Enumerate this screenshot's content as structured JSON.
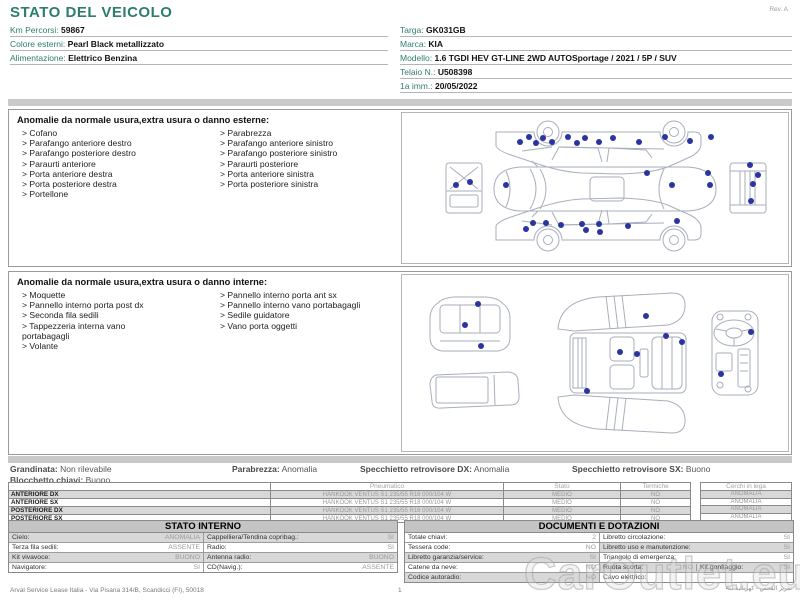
{
  "colors": {
    "accent": "#2e7d6e",
    "dot": "#2b35a0",
    "bar": "#c9c9c9",
    "row_gray": "#d8d8d8",
    "head_gray": "#c4c4c4"
  },
  "header": {
    "title": "STATO DEL VEICOLO",
    "rev": "Rev. A"
  },
  "vehicle_info": {
    "left": [
      {
        "label": "Km Percorsi:",
        "value": "59867"
      },
      {
        "label": "Colore esterni:",
        "value": "Pearl Black metallizzato"
      },
      {
        "label": "Alimentazione:",
        "value": "Elettrico Benzina"
      }
    ],
    "right": [
      {
        "label": "Targa:",
        "value": "GK031GB"
      },
      {
        "label": "Marca:",
        "value": "KIA"
      },
      {
        "label": "Modello:",
        "value": "1.6 TGDI HEV GT-LINE 2WD AUTOSportage / 2021 / 5P / SUV"
      },
      {
        "label": "Telaio N.:",
        "value": "U508398"
      },
      {
        "label": "1a imm.:",
        "value": "20/05/2022"
      }
    ]
  },
  "exterior_panel": {
    "title": "Anomalie da normale usura,extra usura o danno esterne:",
    "col1": [
      "> Cofano",
      "> Parafango anteriore destro",
      "> Parafango posteriore destro",
      "> Paraurti anteriore",
      "> Porta anteriore destra",
      "> Porta posteriore destra",
      "> Portellone"
    ],
    "col2": [
      "> Parabrezza",
      "> Parafango anteriore sinistro",
      "> Parafango posteriore sinistro",
      "> Paraurti posteriore",
      "> Porta anteriore sinistra",
      "> Porta posteriore sinistra"
    ]
  },
  "interior_panel": {
    "title": "Anomalie da normale usura,extra usura o danno interne:",
    "col1": [
      "> Moquette",
      "> Pannello interno porta post dx",
      "> Seconda fila sedili",
      "> Tappezzeria interna vano portabagagli",
      "> Volante"
    ],
    "col2": [
      "> Pannello interno porta ant sx",
      "> Pannello interno vano portabagagli",
      "> Sedile guidatore",
      "> Vano porta oggetti"
    ]
  },
  "summary": {
    "items": [
      {
        "label": "Grandinata:",
        "value": "Non rilevabile"
      },
      {
        "label": "Parabrezza:",
        "value": "Anomalia"
      },
      {
        "label": "Specchietto retrovisore DX:",
        "value": "Anomalia"
      },
      {
        "label": "Specchietto retrovisore SX:",
        "value": "Buono"
      }
    ],
    "line2": {
      "label": "Blocchetto chiavi:",
      "value": "Buono"
    }
  },
  "tyres": {
    "headers": {
      "pneumatico": "Pneumatico",
      "stato": "Stato",
      "termiche": "Termiche",
      "cerchi": "Cerchi in lega"
    },
    "rows": [
      {
        "pos": "ANTERIORE DX",
        "spec": "HANKOOK VENTUS S1 235/55 R18 000/104 W",
        "stato": "MEDIO",
        "termiche": "NO",
        "cerchi": "ANOMALIA"
      },
      {
        "pos": "ANTERIORE SX",
        "spec": "HANKOOK VENTUS S1 235/55 R18 000/104 W",
        "stato": "MEDIO",
        "termiche": "NO",
        "cerchi": "ANOMALIA"
      },
      {
        "pos": "POSTERIORE DX",
        "spec": "HANKOOK VENTUS S1 235/55 R18 000/104 W",
        "stato": "MEDIO",
        "termiche": "NO",
        "cerchi": "ANOMALIA"
      },
      {
        "pos": "POSTERIORE SX",
        "spec": "HANKOOK VENTUS S1 235/55 R18 000/104 W",
        "stato": "MEDIO",
        "termiche": "NO",
        "cerchi": "ANOMALIA"
      }
    ]
  },
  "stato_interno": {
    "title": "STATO INTERNO",
    "rows": [
      [
        {
          "label": "Cielo:",
          "value": "ANOMALIA"
        },
        {
          "label": "Cappelliera/Tendina copribag.:",
          "value": "SI"
        }
      ],
      [
        {
          "label": "Terza fila sedili:",
          "value": "ASSENTE"
        },
        {
          "label": "Radio:",
          "value": "SI"
        }
      ],
      [
        {
          "label": "Kit vivavoce:",
          "value": "BUONO"
        },
        {
          "label": "Antenna radio:",
          "value": "BUONO"
        }
      ],
      [
        {
          "label": "Navigatore:",
          "value": "SI"
        },
        {
          "label": "CD(Navig.):",
          "value": "ASSENTE"
        }
      ]
    ]
  },
  "documenti": {
    "title": "DOCUMENTI E DOTAZIONI",
    "rows": [
      [
        {
          "label": "Totale chiavi:",
          "value": "2"
        },
        {
          "label": "Libretto circolazione:",
          "value": "SI"
        }
      ],
      [
        {
          "label": "Tessera code:",
          "value": "NO"
        },
        {
          "label": "Libretto uso e manutenzione:",
          "value": "SI"
        }
      ],
      [
        {
          "label": "Libretto garanzia/service:",
          "value": "SI"
        },
        {
          "label": "Triangolo di emergenza:",
          "value": "SI"
        }
      ],
      [
        {
          "label": "Catene da neve:",
          "value": "NO"
        },
        {
          "label": "Ruota scorta:",
          "value": "NO"
        },
        {
          "label": "Kit gonfiaggio:",
          "value": "SI"
        }
      ],
      [
        {
          "label": "Codice autoradio:",
          "value": "NO"
        },
        {
          "label": "Cavo elettrico:",
          "value": ""
        }
      ]
    ]
  },
  "footer": {
    "company": "Arval Service Lease Italia - Via Pisana 314/B, Scandicci (FI), 50018",
    "page": "1",
    "note": "4D تقرير الفحص - كهربائية",
    "watermark": "CarOutlet.eu"
  },
  "diagrams": {
    "exterior": {
      "dots": [
        [
          118,
          29
        ],
        [
          127,
          24
        ],
        [
          134,
          30
        ],
        [
          141,
          25
        ],
        [
          150,
          29
        ],
        [
          166,
          24
        ],
        [
          175,
          30
        ],
        [
          183,
          25
        ],
        [
          197,
          29
        ],
        [
          211,
          25
        ],
        [
          237,
          29
        ],
        [
          263,
          24
        ],
        [
          288,
          28
        ],
        [
          309,
          24
        ],
        [
          104,
          72
        ],
        [
          245,
          60
        ],
        [
          270,
          72
        ],
        [
          306,
          60
        ],
        [
          308,
          72
        ],
        [
          54,
          72
        ],
        [
          68,
          69
        ],
        [
          348,
          52
        ],
        [
          356,
          62
        ],
        [
          351,
          71
        ],
        [
          349,
          88
        ],
        [
          131,
          110
        ],
        [
          124,
          116
        ],
        [
          144,
          110
        ],
        [
          159,
          112
        ],
        [
          180,
          111
        ],
        [
          184,
          117
        ],
        [
          197,
          111
        ],
        [
          198,
          119
        ],
        [
          226,
          113
        ],
        [
          275,
          108
        ]
      ]
    },
    "interior": {
      "dots": [
        [
          76,
          29
        ],
        [
          63,
          50
        ],
        [
          79,
          71
        ],
        [
          244,
          41
        ],
        [
          264,
          61
        ],
        [
          280,
          67
        ],
        [
          218,
          77
        ],
        [
          235,
          79
        ],
        [
          185,
          116
        ],
        [
          349,
          57
        ],
        [
          319,
          99
        ]
      ]
    }
  }
}
